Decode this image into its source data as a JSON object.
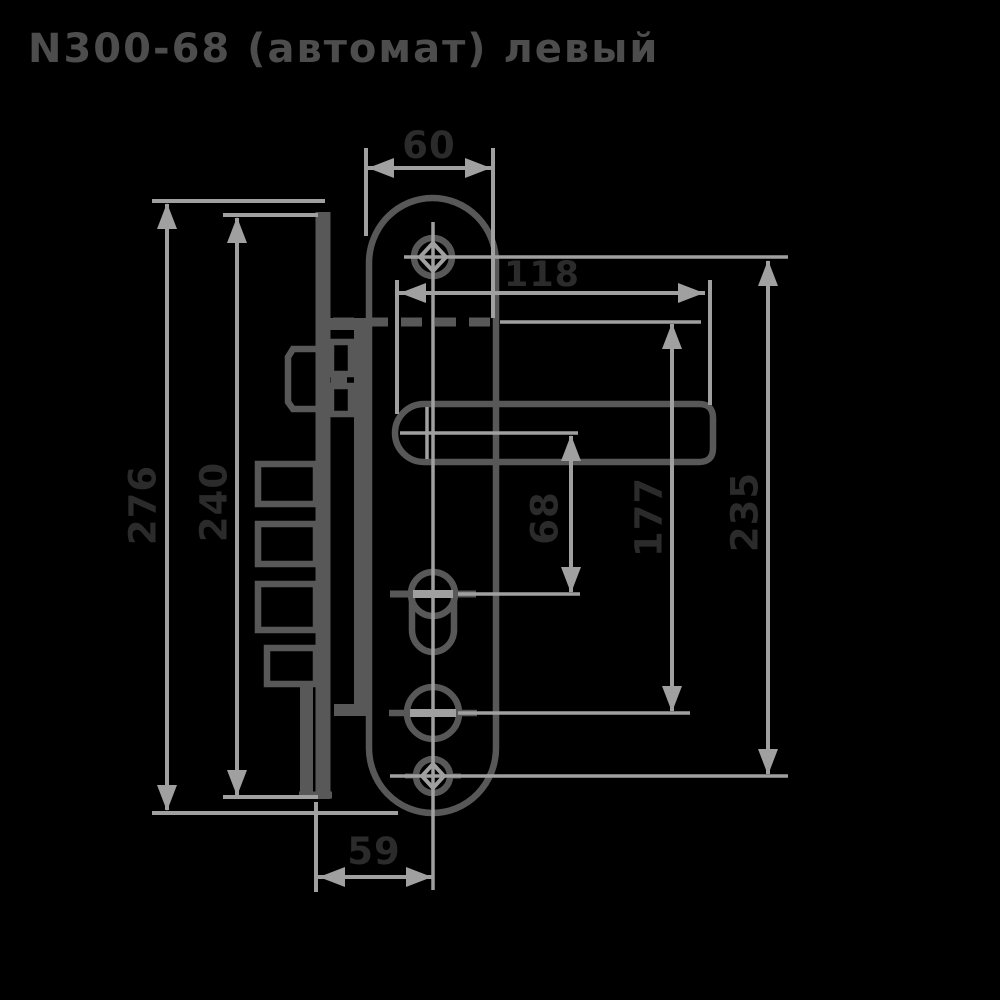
{
  "title": "N300-68 (автомат) левый",
  "colors": {
    "bg": "#000000",
    "object": "#585858",
    "dim": "#a0a0a0",
    "label": "#2b2b2b",
    "title": "#4d4d4d"
  },
  "drawing": {
    "type": "technical-drawing",
    "subject": "mortise lock with lever handle, front view of faceplate and side view of lock body",
    "units": "mm"
  },
  "dimensions": {
    "faceplate_width": "60",
    "handle_length": "118",
    "overall_height": "276",
    "body_height": "240",
    "handle_to_cylinder": "68",
    "handle_to_knob": "177",
    "screw_spacing": "235",
    "backset": "59"
  }
}
